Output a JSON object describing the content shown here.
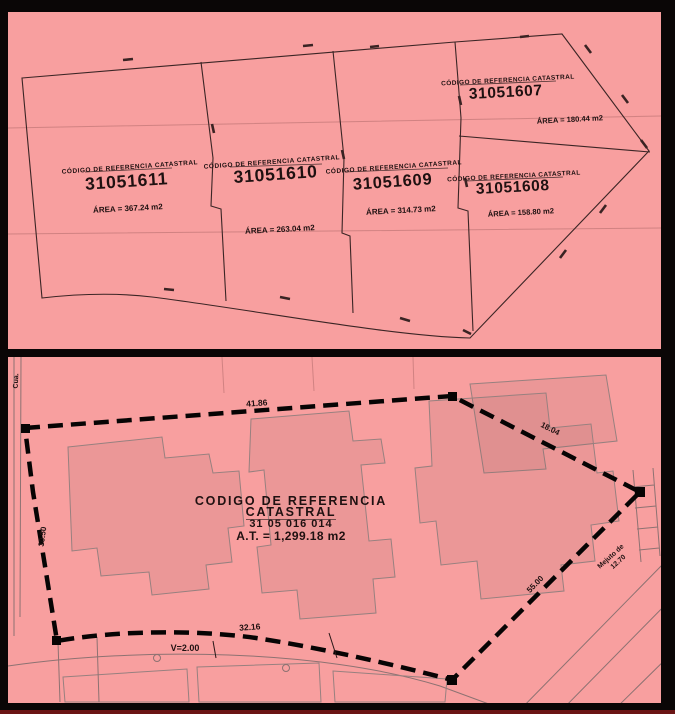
{
  "colors": {
    "background": "#f89f9f",
    "frame": "#0a0606",
    "line": "#3b2525",
    "boundary": "#070404",
    "building_stroke": "#97807f",
    "bottom_accent": "#6b1515"
  },
  "top_plan": {
    "parcels": [
      {
        "header": "CÓDIGO DE REFERENCIA CATASTRAL",
        "code": "31051611",
        "area": "ÁREA = 367.24 m2"
      },
      {
        "header": "CÓDIGO DE REFERENCIA CATASTRAL",
        "code": "31051610",
        "area": "ÁREA = 263.04 m2"
      },
      {
        "header": "CÓDIGO DE REFERENCIA CATASTRAL",
        "code": "31051609",
        "area": "ÁREA = 314.73 m2"
      },
      {
        "header": "CÓDIGO DE REFERENCIA CATASTRAL",
        "code": "31051608",
        "area": "ÁREA = 158.80 m2"
      },
      {
        "header": "CÓDIGO DE REFERENCIA CATASTRAL",
        "code": "31051607",
        "area": "ÁREA = 180.44 m2"
      }
    ]
  },
  "bottom_plan": {
    "title_line1": "CODIGO DE REFERENCIA",
    "title_line2": "CATASTRAL",
    "reference_code": "31 05 016 014",
    "total_area": "A.T. = 1,299.18 m2",
    "dim_top": "41.86",
    "dim_right_upper": "18.04",
    "dim_right_lower": "55.00",
    "dim_left": "30.50",
    "dim_bottom": "32.16",
    "dim_setback": "V=2.00",
    "street_right_name": "Mejuto de",
    "street_right_width": "12.70",
    "street_left_label": "Cua."
  }
}
